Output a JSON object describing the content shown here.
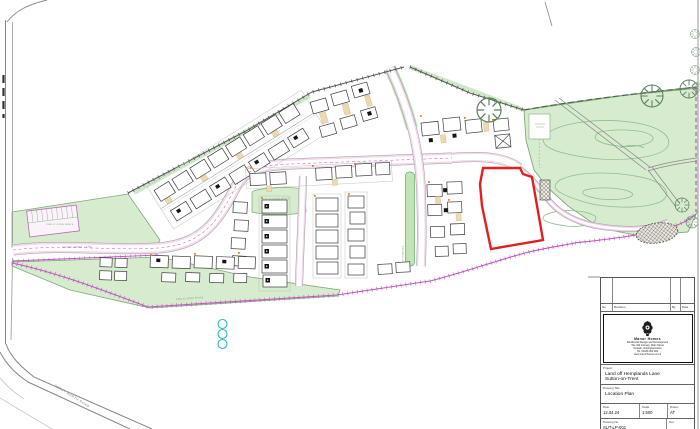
{
  "plan": {
    "road_labels": {
      "great_north_road": "GREAT NORTH ROAD",
      "hemplands_lane": "HEMPLANDS LANE",
      "private_drive": "PRIVATE DRIVE"
    },
    "area_labels": {
      "pos1": "PUBLIC OPEN SPACE",
      "pos2": "PUBLIC OPEN SPACE",
      "pos3": "PUBLIC OPEN SPACE"
    }
  },
  "title_block": {
    "revision_table": {
      "col_no": "No.",
      "col_revision": "Revision",
      "col_by": "By",
      "col_date": "Date"
    },
    "logo": {
      "company": "Manor Homes",
      "tagline": "Residential Design and Development",
      "address_line1": "The Old Granary, Main Street",
      "address_line2": "Newark, Nottinghamshire",
      "address_line3": "Tel: 01636 000 000",
      "address_line4": "www.manorhomes.co.uk"
    },
    "project": {
      "label": "Project",
      "line1": "Land off Hemplands Lane",
      "line2": "Sutton-on-Trent"
    },
    "drawing": {
      "label": "Drawing Title",
      "value": "Location Plan"
    },
    "date": {
      "label": "Date",
      "value": "12.04.24"
    },
    "scale": {
      "label": "Scale",
      "value": "1:500"
    },
    "drawn": {
      "label": "Drawn",
      "value": "AT"
    },
    "number": {
      "label": "Drawing No.",
      "value": "SUT-LP-001"
    },
    "revision": {
      "label": "Rev",
      "value": ""
    }
  },
  "colors": {
    "red_line": "#e02020",
    "magenta": "#bf58bd",
    "green_open": "#d7ebcf",
    "green_edge": "#7cab77",
    "green_contour": "#8fbe8d",
    "teal": "#2fb9b9",
    "tan": "#ecd9b4",
    "road_pink": "#f3d9ee"
  }
}
